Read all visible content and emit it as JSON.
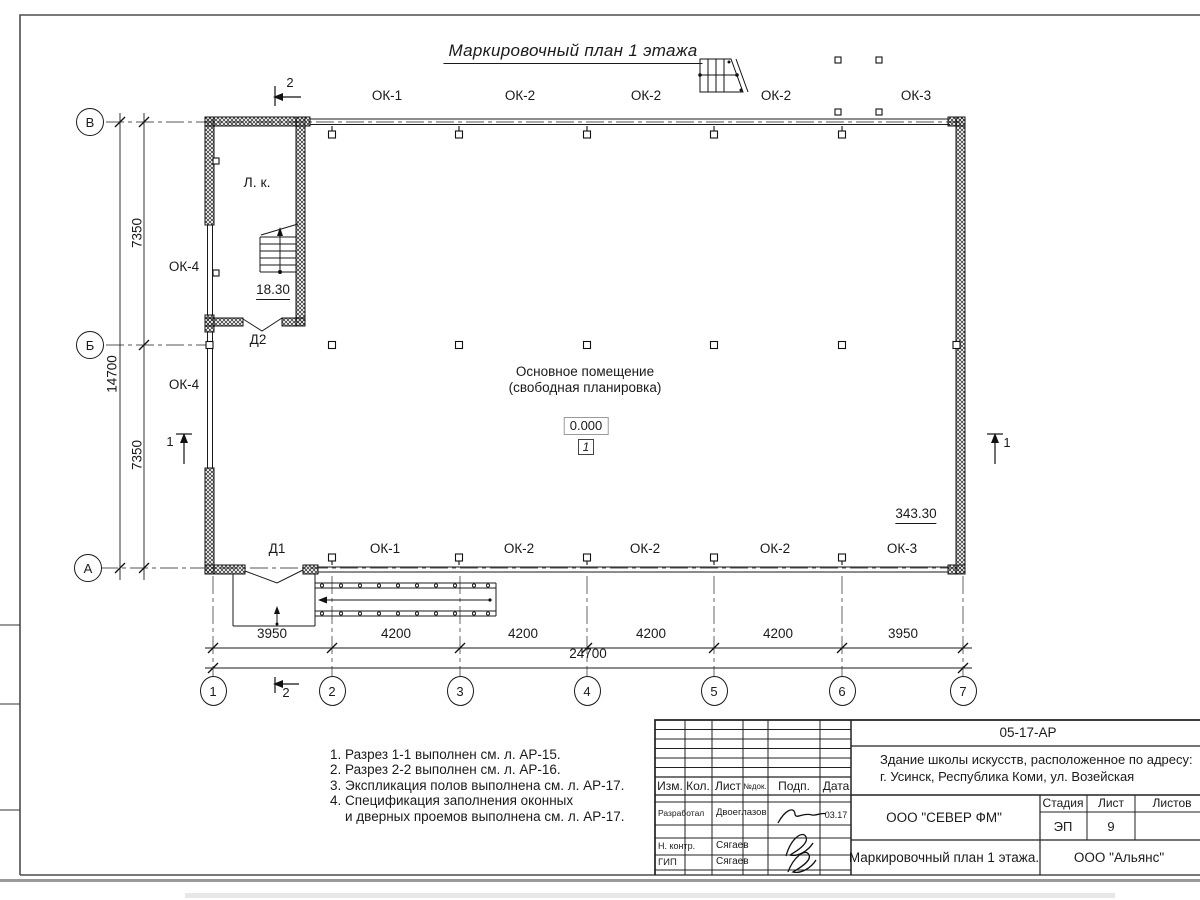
{
  "title": "Маркировочный план 1 этажа",
  "plan": {
    "stair_room": "Л. к.",
    "stair_elevation": "18.30",
    "right_elevation": "343.30",
    "room_line1": "Основное помещение",
    "room_line2": "(свободная планировка)",
    "room_elevation": "0.000",
    "room_number": "1",
    "door1": "Д1",
    "door2": "Д2",
    "window_left_top": "ОК-4",
    "window_left_bottom": "ОК-4",
    "windows_top": [
      "ОК-1",
      "ОК-2",
      "ОК-2",
      "ОК-2",
      "ОК-3"
    ],
    "windows_bottom": [
      "ОК-1",
      "ОК-2",
      "ОК-2",
      "ОК-2",
      "ОК-3"
    ]
  },
  "axes": {
    "rows": [
      "В",
      "Б",
      "А"
    ],
    "cols": [
      "1",
      "2",
      "3",
      "4",
      "5",
      "6",
      "7"
    ]
  },
  "dims": {
    "bottom": [
      "3950",
      "4200",
      "4200",
      "4200",
      "4200",
      "3950"
    ],
    "bottom_total": "24700",
    "left_top": "7350",
    "left_total": "14700",
    "left_bottom": "7350"
  },
  "sections": {
    "s1": "1",
    "s2": "2"
  },
  "notes": [
    "1. Разрез 1-1 выполнен см. л. АР-15.",
    "2. Разрез 2-2 выполнен см. л. АР-16.",
    "3. Экспликация полов выполнена см. л. АР-17.",
    "4. Спецификация заполнения оконных",
    "и дверных проемов выполнена см. л. АР-17."
  ],
  "title_block": {
    "doc_number": "05-17-АР",
    "project_line1": "Здание школы искусств, расположенное по адресу:",
    "project_line2": "г. Усинск, Республика Коми, ул. Возейская",
    "header": {
      "izm": "Изм.",
      "kol": "Кол.",
      "list": "Лист",
      "ndoc": "№док.",
      "podp": "Подп.",
      "data": "Дата"
    },
    "rows": [
      {
        "role": "Разработал",
        "name": "Двоеглазов",
        "date": "03.17"
      },
      {
        "role": "Н. контр.",
        "name": "Сягаев",
        "date": ""
      },
      {
        "role": "ГИП",
        "name": "Сягаев",
        "date": ""
      }
    ],
    "org1": "ООО \"СЕВЕР ФМ\"",
    "org2": "ООО \"Альянс\"",
    "stage_header": {
      "stage": "Стадия",
      "sheet": "Лист",
      "sheets": "Листов"
    },
    "stage_values": {
      "stage": "ЭП",
      "sheet": "9",
      "sheets": ""
    },
    "drawing_name": "Маркировочный план 1 этажа."
  },
  "colors": {
    "line": "#1a1a1a",
    "frame": "#4d4d4d",
    "sheet_edge": "#999999"
  }
}
